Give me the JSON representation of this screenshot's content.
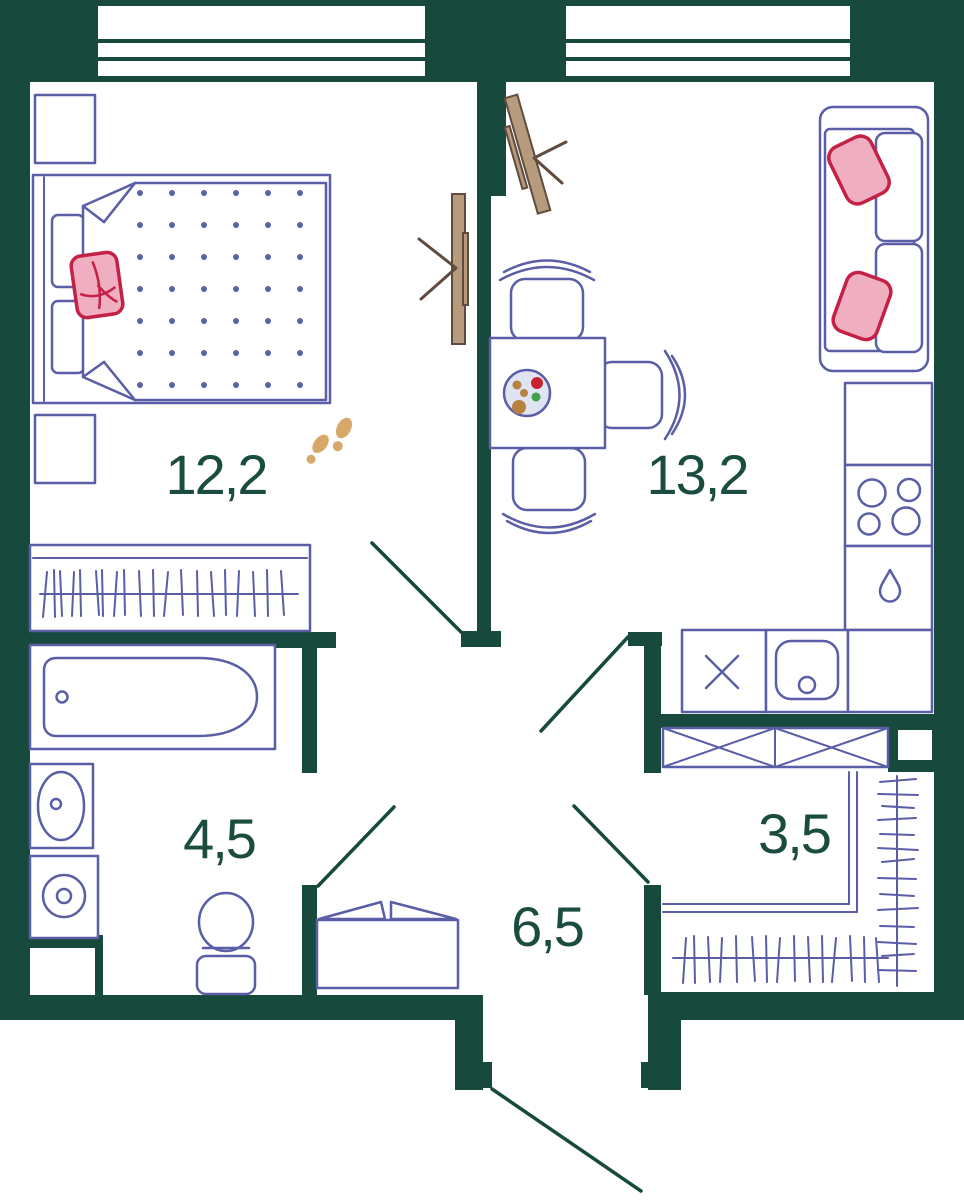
{
  "plan_title": "one-bedroom apartment floor plan",
  "areas": {
    "bedroom": "12,2",
    "living_kitchen": "13,2",
    "bathroom": "4,5",
    "hallway": "6,5",
    "closet": "3,5"
  },
  "colors": {
    "wall": "#17493c",
    "furniture": "#5a5ea6",
    "label": "#1a4c3f",
    "pillow-red": "#c52045",
    "pillow-pink": "#f0afc0",
    "door-wood": "#b79b7d",
    "door-wood-dark": "#5f4c3e",
    "footprint": "#d8a76a",
    "plate-fill": "#e0e3f2",
    "food-red": "#c8232c",
    "food-brown": "#b5813f",
    "food-green": "#3fa34d"
  }
}
